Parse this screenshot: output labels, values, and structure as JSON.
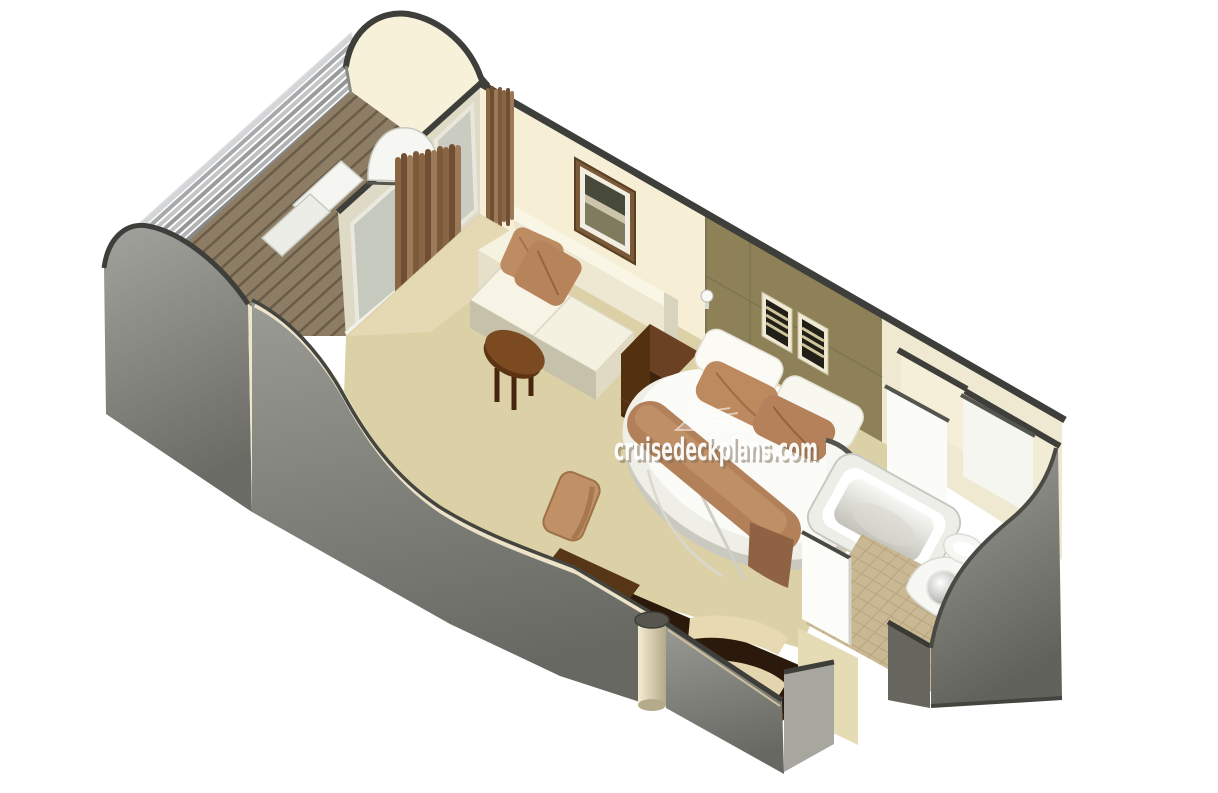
{
  "watermark": {
    "text": "cruisedeckplans.com"
  },
  "palette": {
    "background": "#ffffff",
    "carpet": "#dcd1a6",
    "carpet_light": "#e7ddb9",
    "wall_cream": "#f6efd6",
    "wall_olive": "#8e8158",
    "wall_edge_dark": "#3e3e3a",
    "outer_wall_gray": "#84847e",
    "deck_wood": "#8d7d64",
    "railing_silver": "#b9babc",
    "curtain_brown": "#8a6544",
    "sofa_cream": "#f2eddb",
    "cushion_brown": "#be8c63",
    "wood_dark": "#3c2410",
    "wood_mid": "#7b4a21",
    "bed_linen": "#fbfbf7",
    "bathroom_tile": "#c9b893",
    "fixture_white": "#f7f7f3"
  },
  "scene": {
    "description": "3D cutaway floor plan of a cruise ship suite cabin",
    "areas": [
      "balcony",
      "living-area",
      "bedroom",
      "bathroom",
      "entrance-corridor"
    ],
    "objects": [
      "balcony-railing",
      "deck-lounger",
      "sliding-glass-door",
      "curtains",
      "sofa",
      "throw-pillows",
      "coffee-table",
      "framed-picture",
      "wall-sconce",
      "louver-panels",
      "nightstand",
      "round-bed",
      "bed-runner",
      "desk-vanity",
      "desk-chair",
      "support-column",
      "bathtub",
      "sink",
      "toilet",
      "closet-door"
    ]
  }
}
